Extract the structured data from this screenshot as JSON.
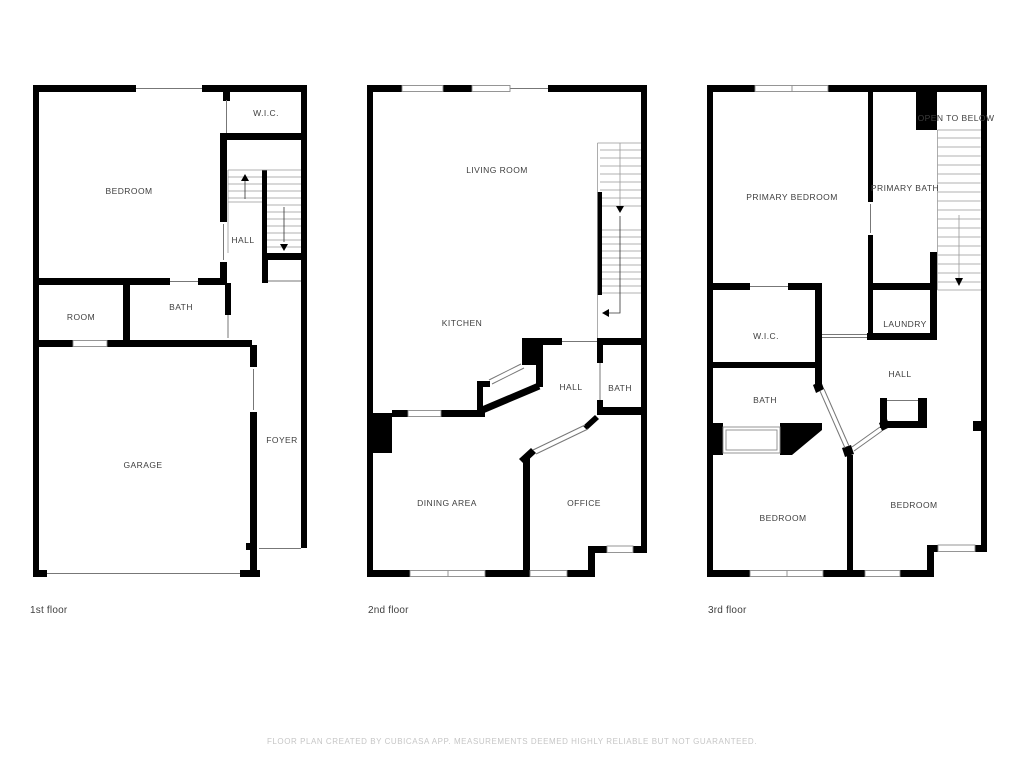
{
  "floors": [
    {
      "caption": "1st floor",
      "rooms": {
        "wic": "W.I.C.",
        "bedroom": "BEDROOM",
        "hall": "HALL",
        "room": "ROOM",
        "bath": "BATH",
        "garage": "GARAGE",
        "foyer": "FOYER"
      }
    },
    {
      "caption": "2nd floor",
      "rooms": {
        "living_room": "LIVING ROOM",
        "kitchen": "KITCHEN",
        "hall": "HALL",
        "bath": "BATH",
        "dining_area": "DINING AREA",
        "office": "OFFICE"
      }
    },
    {
      "caption": "3rd floor",
      "rooms": {
        "primary_bedroom": "PRIMARY BEDROOM",
        "primary_bath": "PRIMARY BATH",
        "open_to_below": "OPEN TO BELOW",
        "wic": "W.I.C.",
        "laundry": "LAUNDRY",
        "bath": "BATH",
        "hall": "HALL",
        "bedroom_left": "BEDROOM",
        "bedroom_right": "BEDROOM"
      }
    }
  ],
  "footer": {
    "disclaimer": "FLOOR PLAN CREATED BY CUBICASA APP. MEASUREMENTS DEEMED HIGHLY RELIABLE BUT NOT GUARANTEED."
  }
}
